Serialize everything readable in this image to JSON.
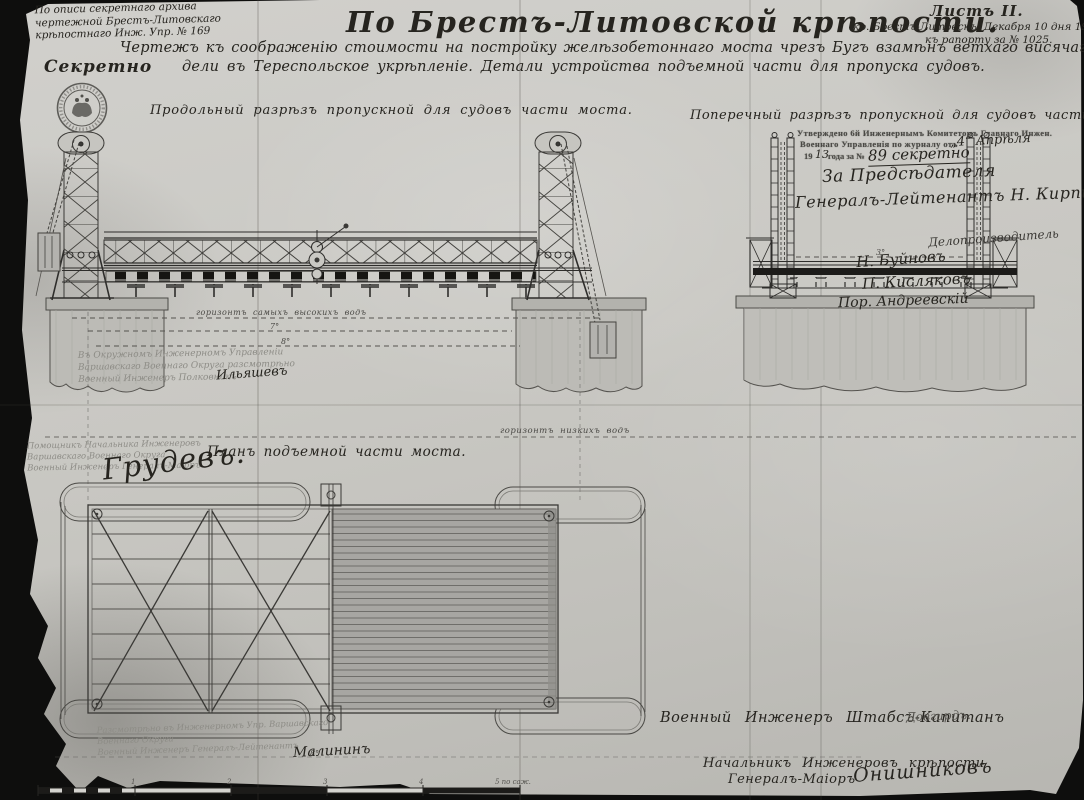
{
  "header": {
    "archive_note": [
      "По описи секретнаго архива",
      "чертежной Брестъ-Литовскаго",
      "крѣпостнаго Инж. Упр. № 169"
    ],
    "secret": "Секретно",
    "title": "По Брестъ-Литовской крѣпости.",
    "subtitle_line1": "Чертежъ къ соображенію стоимости на постройку желѣзобетоннаго моста чрезъ Бугъ взамѣнъ ветхаго висячаго № 16 ведущаго изъ цита-",
    "subtitle_line2": "дели въ Тереспольское укрѣпленіе. Детали устройства подъемной части для пропуска судовъ.",
    "sheet_label": "Листъ II.",
    "place_date": "кр. Брестъ-Литовскъ. Декабря 10 дня 1911 года",
    "report_no": "къ рапорту за № 1025."
  },
  "views": {
    "longitudinal_label": "Продольный разрѣзъ пропускной для судовъ части моста.",
    "transverse_label": "Поперечный разрѣзъ пропускной для судовъ части моста.",
    "plan_label": "Планъ подъемной части моста."
  },
  "approval_stamp": {
    "line1": "Утверждено 6й Инженернымъ Комитетомъ Главнаго Инжен.",
    "line2_printed": "Военнаго Управленія по журналу отъ",
    "line2_hand": "„4“ Апрѣля",
    "line3_printed_a": "19",
    "line3_hand_year": "13",
    "line3_printed_b": "года за №",
    "line3_hand": "89 секретно"
  },
  "signatures_right": {
    "for_chairman": "За Предсѣдателя",
    "general": "Генералъ-Лейтенантъ Н. Кирпичевъ",
    "sig1": "Делопроизводитель",
    "sig2": "Н. Буйновъ",
    "sig3": "П. Кисляковъ",
    "sig4": "Пор. Андреевскій"
  },
  "review_note_left": {
    "line1": "Въ Окружномъ Инженерномъ Управленіи",
    "line2": "Варшавскаго Военнаго Округа разсмотрѣно",
    "line3": "Военный Инженеръ Полковникъ",
    "signature": "Ильяшевъ"
  },
  "assistant_note": {
    "line1": "Помощникъ Начальника Инженеровъ",
    "line2": "Варшавскаго Военнаго Округа",
    "line3": "Военный Инженеръ Генералъ-Маіоръ",
    "signature": "Грудевъ."
  },
  "water_levels": {
    "high": "горизонтъ самыхъ высокихъ водъ",
    "low": "горизонтъ низкихъ водъ",
    "mark_7": "7°",
    "mark_8": "8°",
    "mark_8b": "8°",
    "mark_3": "3°"
  },
  "bottom_left_note": {
    "line1": "Разсмотрѣно въ Инженерномъ Упр. Варшавскаго",
    "line2": "Военнаго Округа",
    "line3": "Военный Инженеръ Генералъ-Лейтенантъ",
    "signature": "Малининъ"
  },
  "bottom_right": {
    "engineer_label": "Военный Инженеръ Штабсъ-Капитанъ",
    "engineer_sig": "Довгирдъ.",
    "chief_line1": "Начальникъ Инженеровъ крѣпости",
    "chief_line2": "Генералъ-Маіоръ",
    "chief_sig": "Онишниковъ"
  },
  "scale_bar": {
    "labels": [
      "1",
      "2",
      "3",
      "4",
      "5 по саж."
    ]
  },
  "colors": {
    "paper": "#c9c8c3",
    "ink": "#2e2d2b",
    "faint_stamp": "#8d8c86"
  }
}
